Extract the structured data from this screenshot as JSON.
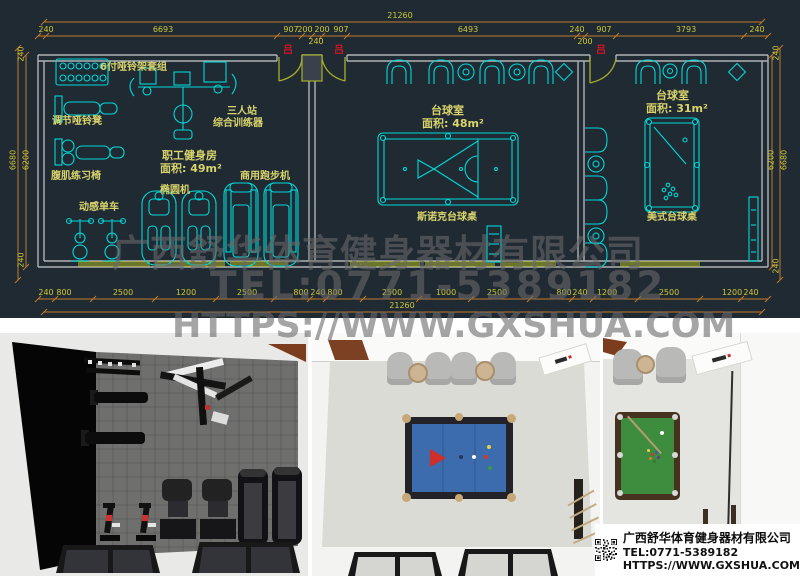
{
  "cad": {
    "total_dim": "21260",
    "dims_top": [
      "240",
      "6693",
      "907",
      "200",
      "200",
      "907",
      "6493",
      "240",
      "907",
      "3793",
      "240"
    ],
    "dims_top_small": [
      "240",
      "200"
    ],
    "dims_bottom": [
      "240",
      "800",
      "2500",
      "1200",
      "2500",
      "800",
      "240",
      "800",
      "2500",
      "1000",
      "2500",
      "800",
      "240",
      "1200",
      "2500",
      "1200",
      "240"
    ],
    "dims_left": [
      "240",
      "6680",
      "6200",
      "240"
    ],
    "dims_right": [
      "240",
      "6200",
      "6680",
      "240"
    ],
    "door_marker": "吕",
    "rooms": {
      "gym": {
        "name": "职工健身房",
        "area": "面积: 49m²"
      },
      "snooker": {
        "name": "台球室",
        "area": "面积: 48m²"
      },
      "pool": {
        "name": "台球室",
        "area": "面积: 31m²"
      }
    },
    "equipment": {
      "dumbbell_rack": "6付哑铃架套组",
      "adj_bench": "调节哑铃凳",
      "ab_chair": "腹肌练习椅",
      "spin_bike": "动感单车",
      "trainer_line1": "三人站",
      "trainer_line2": "综合训练器",
      "elliptical": "椭圆机",
      "treadmill": "商用跑步机",
      "snooker_table": "斯诺克台球桌",
      "pool_table": "美式台球桌"
    },
    "colors": {
      "background": "#202a33",
      "cyan": "#00d8d8",
      "label_yellow": "#d9d46c",
      "dim_yellow": "#cdc938",
      "dim_line_orange": "#c1792a",
      "window_green": "#9aa423",
      "door_green": "#a4ae2b",
      "wall_gray": "#aeb2b5",
      "marker_red": "#d21622"
    }
  },
  "watermark": {
    "line1": "广西舒华体育健身器材有限公司",
    "line2": "TEL:0771-5389182",
    "line3": "HTTPS://WWW.GXSHUA.COM"
  },
  "company": {
    "name": "广西舒华体育健身器材有限公司",
    "tel": "TEL:0771-5389182",
    "url": "HTTPS://WWW.GXSHUA.COM"
  }
}
